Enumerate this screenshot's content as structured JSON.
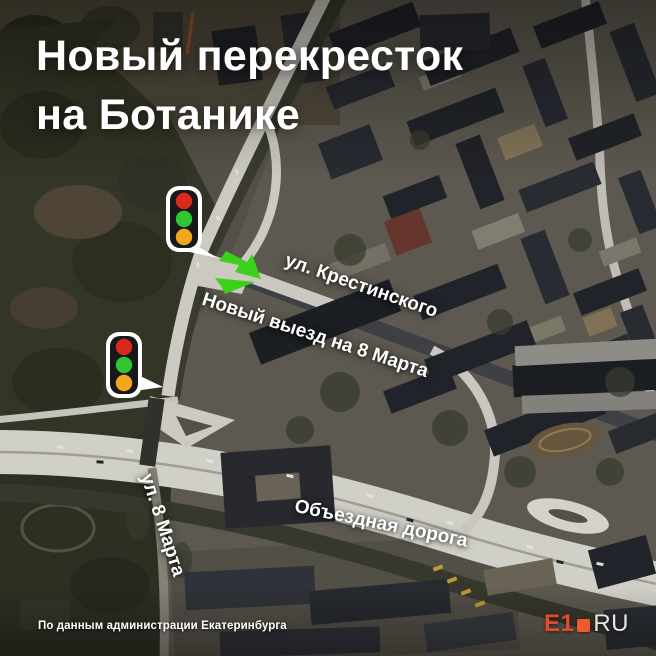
{
  "title": {
    "line1": "Новый перекресток",
    "line2": "на Ботанике"
  },
  "map": {
    "labels": {
      "krestinskogo": "ул. Крестинского",
      "new_exit": "Новый выезд на 8 Марта",
      "marta8": "ул. 8 Марта",
      "obezdnaya": "Объездная дорога"
    },
    "traffic_light": {
      "red": "#d8291c",
      "green": "#2ec732",
      "amber": "#f3a81b"
    },
    "arrow_color": "#3bd11a"
  },
  "footer": {
    "attribution": "По данным администрации Екатеринбурга"
  },
  "logo": {
    "e1": "E1",
    "ru": "RU",
    "accent": "#e8492a",
    "square": "#ee5a2b",
    "ru_color": "#e6e6e6"
  }
}
